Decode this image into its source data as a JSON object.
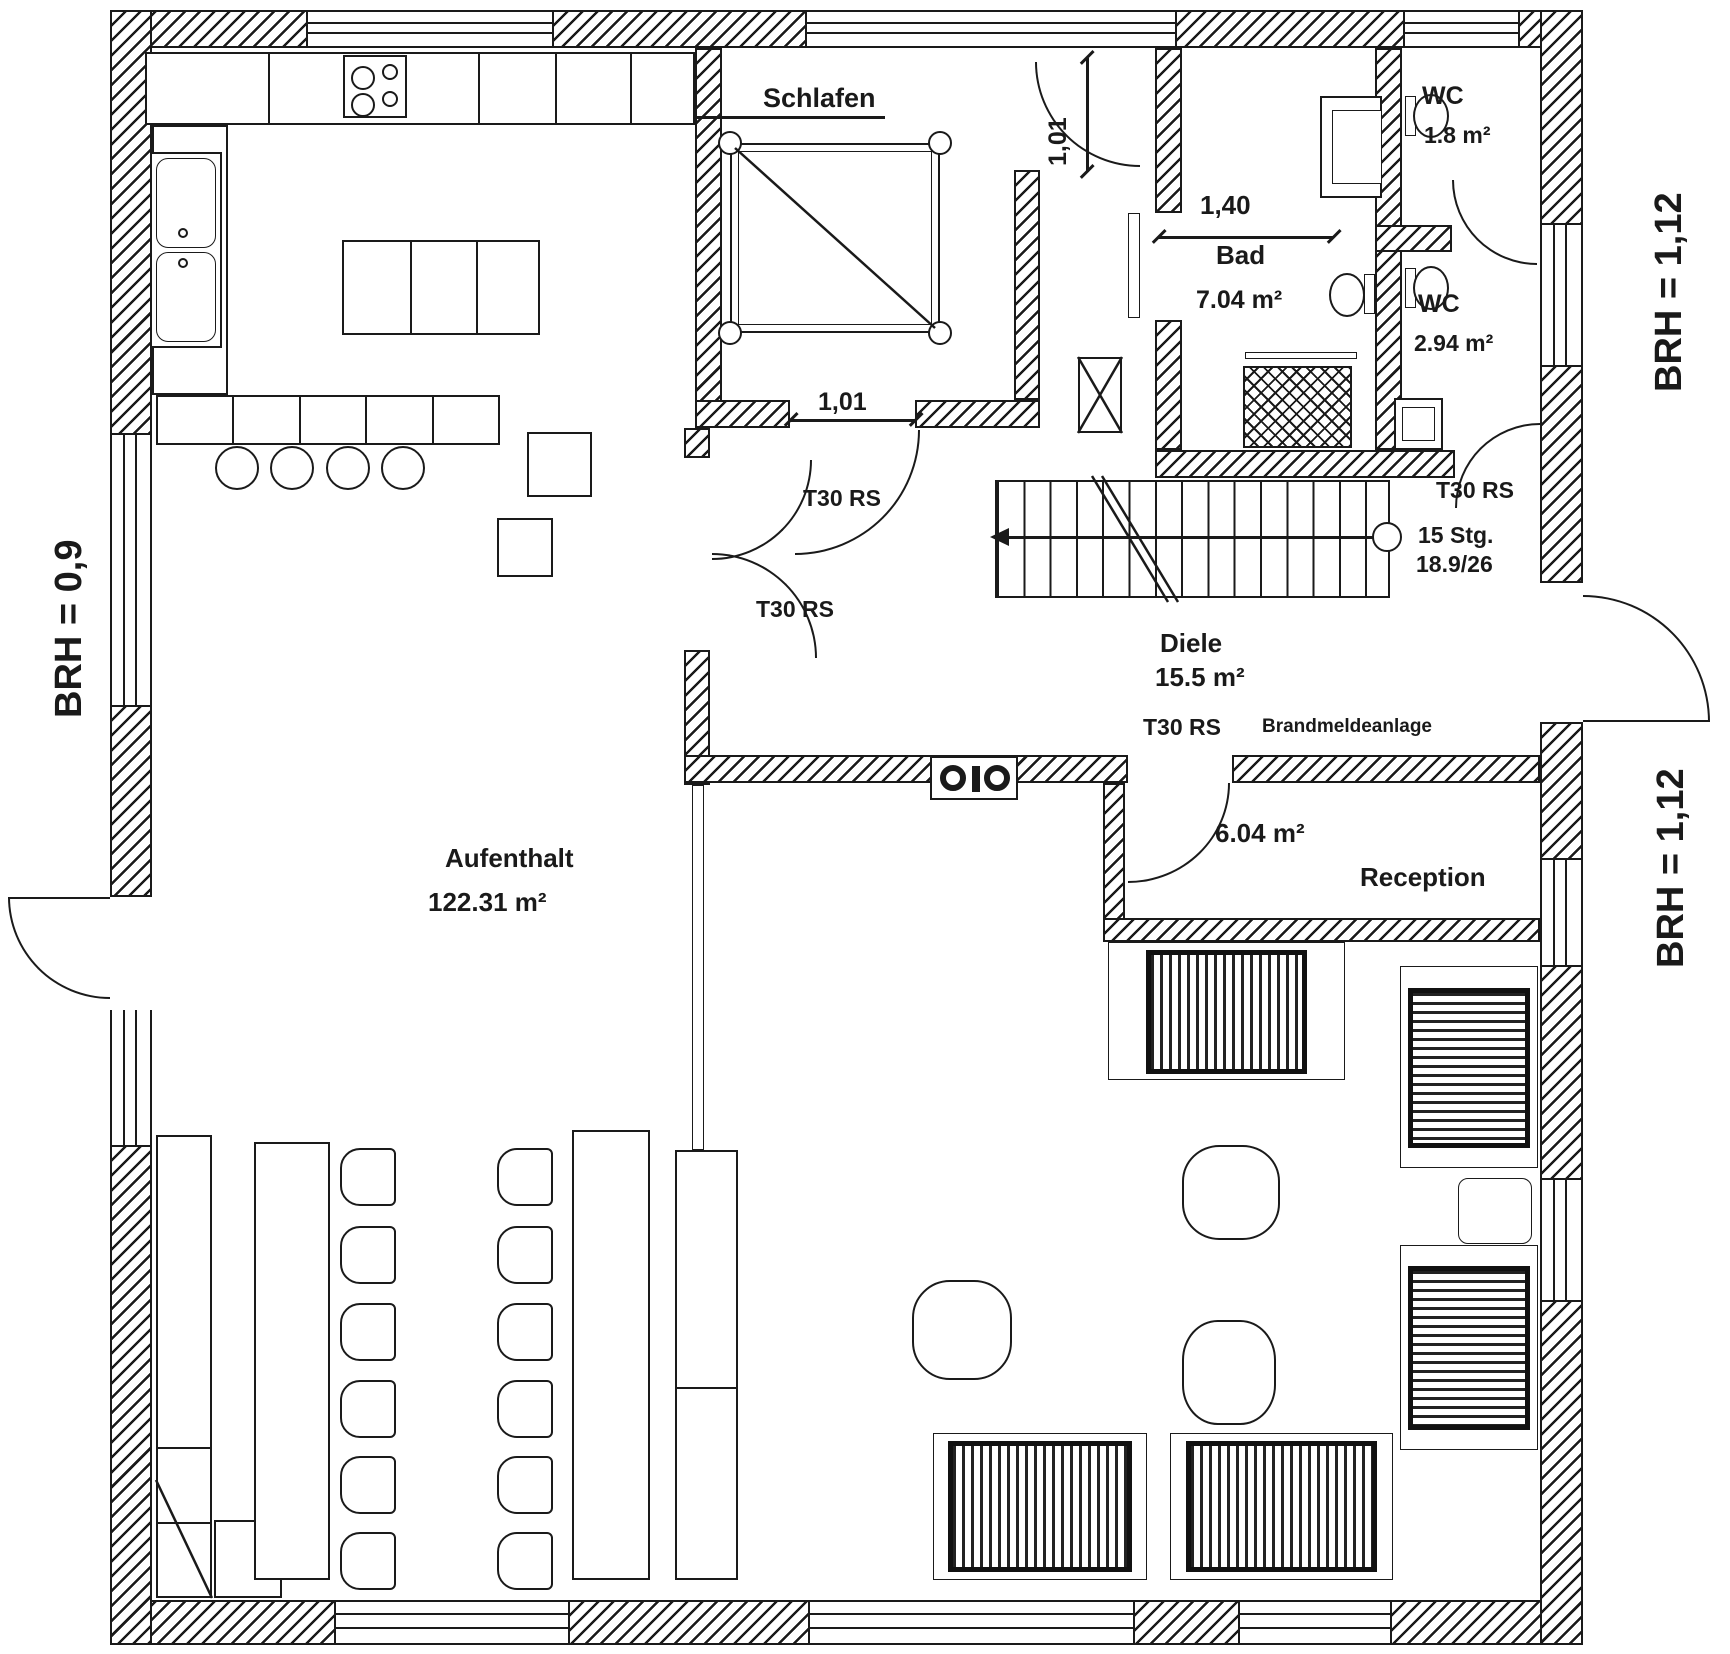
{
  "plan": {
    "rooms": {
      "schlafen": {
        "label": "Schlafen"
      },
      "bad": {
        "label": "Bad",
        "area": "7.04 m²"
      },
      "wc_small": {
        "label": "WC",
        "area": "1.8 m²"
      },
      "wc_large": {
        "label": "WC",
        "area": "2.94 m²"
      },
      "diele": {
        "label": "Diele",
        "area": "15.5 m²"
      },
      "reception": {
        "label": "Reception",
        "area": "6.04 m²"
      },
      "aufenthalt": {
        "label": "Aufenthalt",
        "area": "122.31 m²"
      }
    },
    "stairs": {
      "count_label": "15 Stg.",
      "ratio_label": "18.9/26"
    },
    "doors": {
      "fire_rating": "T30 RS"
    },
    "annotations": {
      "fire_alarm": "Brandmeldeanlage"
    },
    "dimensions": {
      "schlafen_door_top": "1,01",
      "schlafen_door_bottom": "1,01",
      "bad_width": "1,40",
      "parapet_left": "BRH = 0,9",
      "parapet_right_top": "BRH = 1,12",
      "parapet_right_mid": "BRH = 1,12"
    },
    "colors": {
      "line": "#1a1a1a",
      "background": "#ffffff"
    }
  }
}
